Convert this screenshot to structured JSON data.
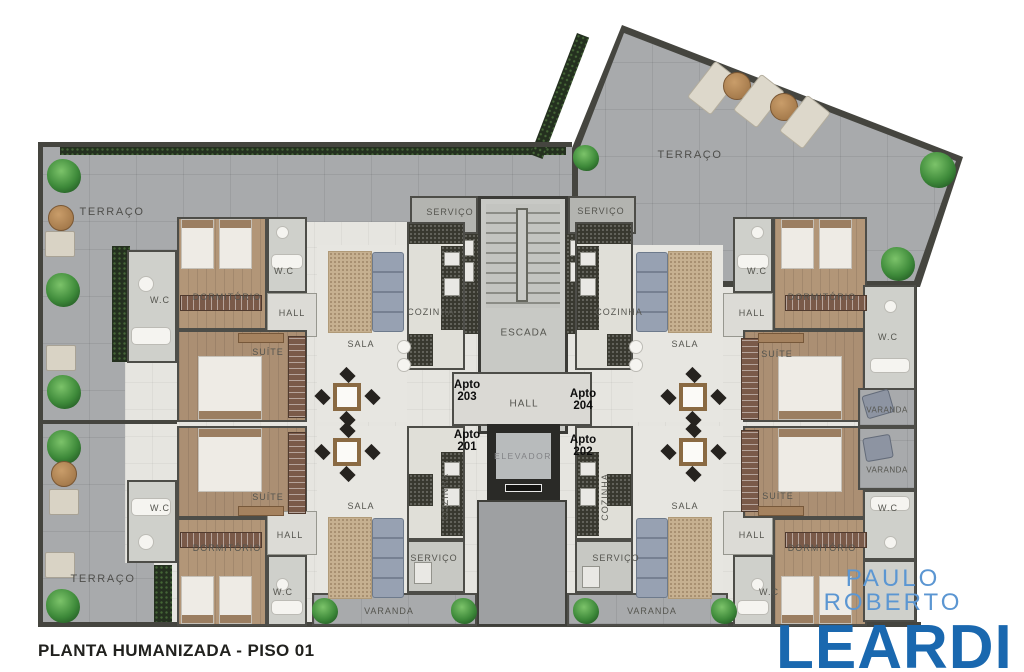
{
  "caption": "PLANTA HUMANIZADA - PISO 01",
  "brand": {
    "line1": "PAULO ROBERTO",
    "line2": "LEARDI"
  },
  "rooms": {
    "terraco": "TERRAÇO",
    "servico": "SERVIÇO",
    "escada": "ESCADA",
    "elevador": "ELEVADOR",
    "hall": "HALL",
    "cozinha": "COZINHA",
    "sala": "SALA",
    "dormitorio": "DORMITÓRIO",
    "suite": "SUÍTE",
    "wc": "W.C",
    "varanda": "VARANDA"
  },
  "units": {
    "label": "Apto",
    "a201": "201",
    "a202": "202",
    "a203": "203",
    "a204": "204"
  },
  "colors": {
    "brand_light": "#5b96d2",
    "brand_dark": "#1a68af",
    "terrace_gray": "#a8aaac",
    "floor": "#e6e5e0",
    "wood": "#b29678",
    "wall": "#45453f",
    "hedge_green": "#24301f",
    "plant_green": "#3e8a3a",
    "sofa_blue": "#97a1b2",
    "rug_beige": "#c6b090",
    "counter_granite": "#38382f"
  }
}
